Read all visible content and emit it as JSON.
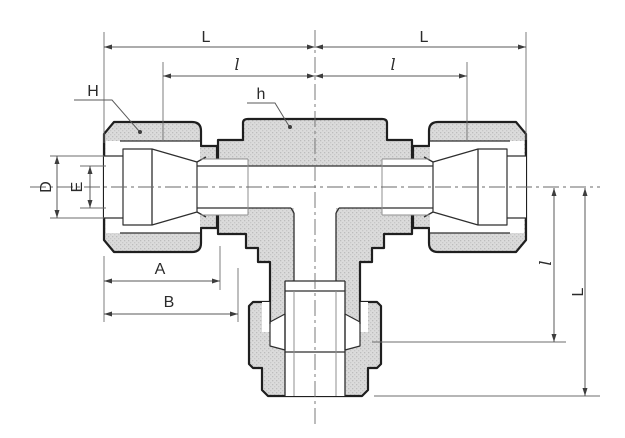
{
  "drawing": {
    "type": "engineering-cross-section",
    "subject": "union-tee-tube-fitting",
    "labels": {
      "top_left_L": "L",
      "top_right_L": "L",
      "top_left_l": "l",
      "top_right_l": "l",
      "nut_H": "H",
      "body_h": "h",
      "bore_D": "D",
      "bore_E": "E",
      "length_A": "A",
      "length_B": "B",
      "right_l": "l",
      "right_L": "L"
    },
    "colors": {
      "outline": "#1f1f1f",
      "metal_fill": "#d9d9d9",
      "dimension_line": "#5a5a5a",
      "background": "#ffffff"
    }
  }
}
